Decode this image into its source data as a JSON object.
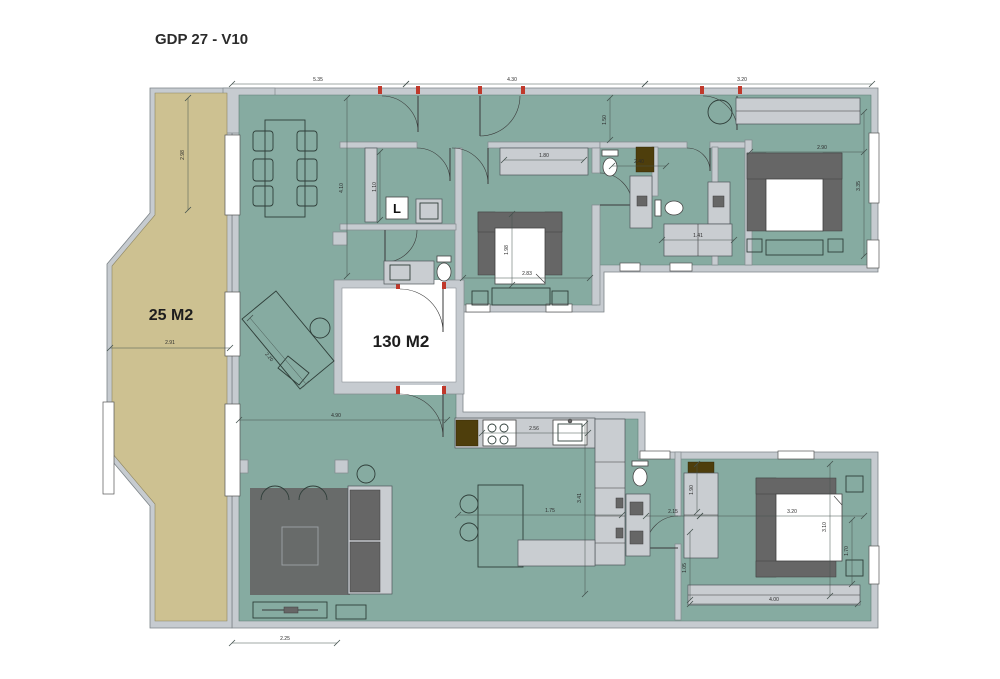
{
  "title": "GDP 27 - V10",
  "labels": {
    "terrace_area": "25 M2",
    "apartment_area": "130 M2",
    "laundry": "L"
  },
  "colors": {
    "wall": "#c6cbd0",
    "floor": "#86aba1",
    "terrace": "#cdc191",
    "furniture_dark": "#666666",
    "cabinet_light": "#c9cdd1",
    "accent_brown": "#4e3e0c",
    "jamb_red": "#c0392b",
    "dimension": "#44534e"
  },
  "dimensions": [
    {
      "x1": 232,
      "y1": 84,
      "x2": 406,
      "y2": 84,
      "label": "5.35",
      "lx": 318,
      "ly": 81,
      "rot": 0
    },
    {
      "x1": 406,
      "y1": 84,
      "x2": 645,
      "y2": 84,
      "label": "4.30",
      "lx": 512,
      "ly": 81,
      "rot": 0
    },
    {
      "x1": 645,
      "y1": 84,
      "x2": 872,
      "y2": 84,
      "label": "3.20",
      "lx": 742,
      "ly": 81,
      "rot": 0
    },
    {
      "x1": 610,
      "y1": 98,
      "x2": 610,
      "y2": 140,
      "label": "1.50",
      "lx": 606,
      "ly": 120,
      "rot": -90
    },
    {
      "x1": 188,
      "y1": 98,
      "x2": 188,
      "y2": 210,
      "label": "2.98",
      "lx": 184,
      "ly": 155,
      "rot": -90
    },
    {
      "x1": 110,
      "y1": 348,
      "x2": 230,
      "y2": 348,
      "label": "2.91",
      "lx": 170,
      "ly": 344,
      "rot": 0
    },
    {
      "x1": 347,
      "y1": 98,
      "x2": 347,
      "y2": 276,
      "label": "4.10",
      "lx": 343,
      "ly": 188,
      "rot": -90
    },
    {
      "x1": 380,
      "y1": 152,
      "x2": 380,
      "y2": 220,
      "label": "1.10",
      "lx": 376,
      "ly": 187,
      "rot": -90
    },
    {
      "x1": 504,
      "y1": 160,
      "x2": 584,
      "y2": 160,
      "label": "1.80",
      "lx": 544,
      "ly": 157,
      "rot": 0
    },
    {
      "x1": 463,
      "y1": 278,
      "x2": 590,
      "y2": 278,
      "label": "2.83",
      "lx": 527,
      "ly": 275,
      "rot": 0
    },
    {
      "x1": 512,
      "y1": 214,
      "x2": 512,
      "y2": 285,
      "label": "1.98",
      "lx": 508,
      "ly": 250,
      "rot": -90
    },
    {
      "x1": 612,
      "y1": 166,
      "x2": 666,
      "y2": 166,
      "label": "2.40",
      "lx": 639,
      "ly": 163,
      "rot": 0
    },
    {
      "x1": 662,
      "y1": 240,
      "x2": 734,
      "y2": 240,
      "label": "1.41",
      "lx": 698,
      "ly": 237,
      "rot": 0
    },
    {
      "x1": 750,
      "y1": 152,
      "x2": 864,
      "y2": 152,
      "label": "2.90",
      "lx": 822,
      "ly": 149,
      "rot": 0
    },
    {
      "x1": 864,
      "y1": 112,
      "x2": 864,
      "y2": 256,
      "label": "3.35",
      "lx": 860,
      "ly": 186,
      "rot": -90
    },
    {
      "x1": 646,
      "y1": 516,
      "x2": 700,
      "y2": 516,
      "label": "2.15",
      "lx": 673,
      "ly": 513,
      "rot": 0
    },
    {
      "x1": 700,
      "y1": 516,
      "x2": 864,
      "y2": 516,
      "label": "3.20",
      "lx": 792,
      "ly": 513,
      "rot": 0
    },
    {
      "x1": 830,
      "y1": 464,
      "x2": 830,
      "y2": 596,
      "label": "3.10",
      "lx": 826,
      "ly": 527,
      "rot": -90
    },
    {
      "x1": 852,
      "y1": 520,
      "x2": 852,
      "y2": 584,
      "label": "1.70",
      "lx": 848,
      "ly": 551,
      "rot": -90
    },
    {
      "x1": 697,
      "y1": 464,
      "x2": 697,
      "y2": 512,
      "label": "1.90",
      "lx": 693,
      "ly": 490,
      "rot": -90
    },
    {
      "x1": 690,
      "y1": 532,
      "x2": 690,
      "y2": 600,
      "label": "1.05",
      "lx": 686,
      "ly": 568,
      "rot": -90
    },
    {
      "x1": 690,
      "y1": 604,
      "x2": 858,
      "y2": 604,
      "label": "4.00",
      "lx": 774,
      "ly": 601,
      "rot": 0
    },
    {
      "x1": 482,
      "y1": 433,
      "x2": 588,
      "y2": 433,
      "label": "2.56",
      "lx": 534,
      "ly": 430,
      "rot": 0
    },
    {
      "x1": 585,
      "y1": 424,
      "x2": 585,
      "y2": 594,
      "label": "3.41",
      "lx": 581,
      "ly": 498,
      "rot": -90
    },
    {
      "x1": 458,
      "y1": 515,
      "x2": 622,
      "y2": 515,
      "label": "1.75",
      "lx": 550,
      "ly": 512,
      "rot": 0
    },
    {
      "x1": 239,
      "y1": 420,
      "x2": 447,
      "y2": 420,
      "label": "4.90",
      "lx": 336,
      "ly": 417,
      "rot": 0
    },
    {
      "x1": 232,
      "y1": 643,
      "x2": 337,
      "y2": 643,
      "label": "2.25",
      "lx": 285,
      "ly": 640,
      "rot": 0
    },
    {
      "x1": 250,
      "y1": 318,
      "x2": 306,
      "y2": 384,
      "label": "2.20",
      "lx": 268,
      "ly": 358,
      "rot": 50
    }
  ]
}
